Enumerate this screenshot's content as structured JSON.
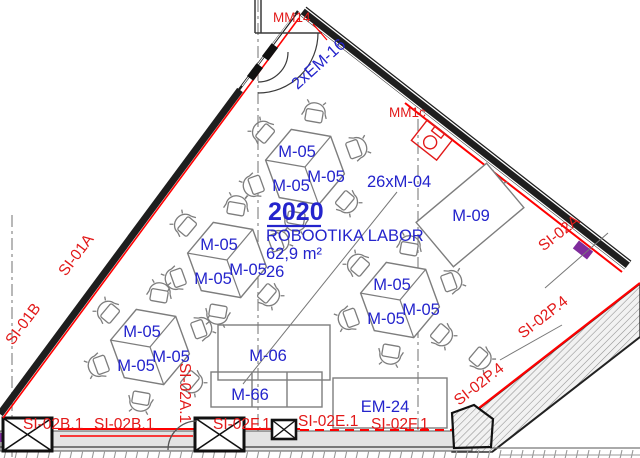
{
  "colors": {
    "label_blue": "#2424cc",
    "label_red": "#e21919",
    "line_red": "#ff0000",
    "wall_dark": "#1e1e1e",
    "furniture_grey": "#7d7d7d",
    "accent_purple": "#7f2c9c"
  },
  "room": {
    "number": "2020",
    "name": "ROBOOTIKA LABOR",
    "area": "62,9 m²",
    "capacity": "26",
    "furniture_note": "26xM-04"
  },
  "furniture_labels": {
    "m05": "M-05",
    "m09": "M-09",
    "m06": "M-06",
    "m66": "M-66",
    "em24": "EM-24"
  },
  "door_labels": {
    "em16": "2xEM-16",
    "mm14": "MM14",
    "mm1c": "MM1c"
  },
  "safety_labels": {
    "si01a": "SI-01A",
    "si01b": "SI-01B",
    "si02b1": "SI-02B.1",
    "si02a1": "SI-02A.1",
    "si02f1": "SI-02F.1",
    "si02e1": "SI-02E.1",
    "si02a": "SI-02A",
    "si02p4": "SI-02P.4"
  }
}
